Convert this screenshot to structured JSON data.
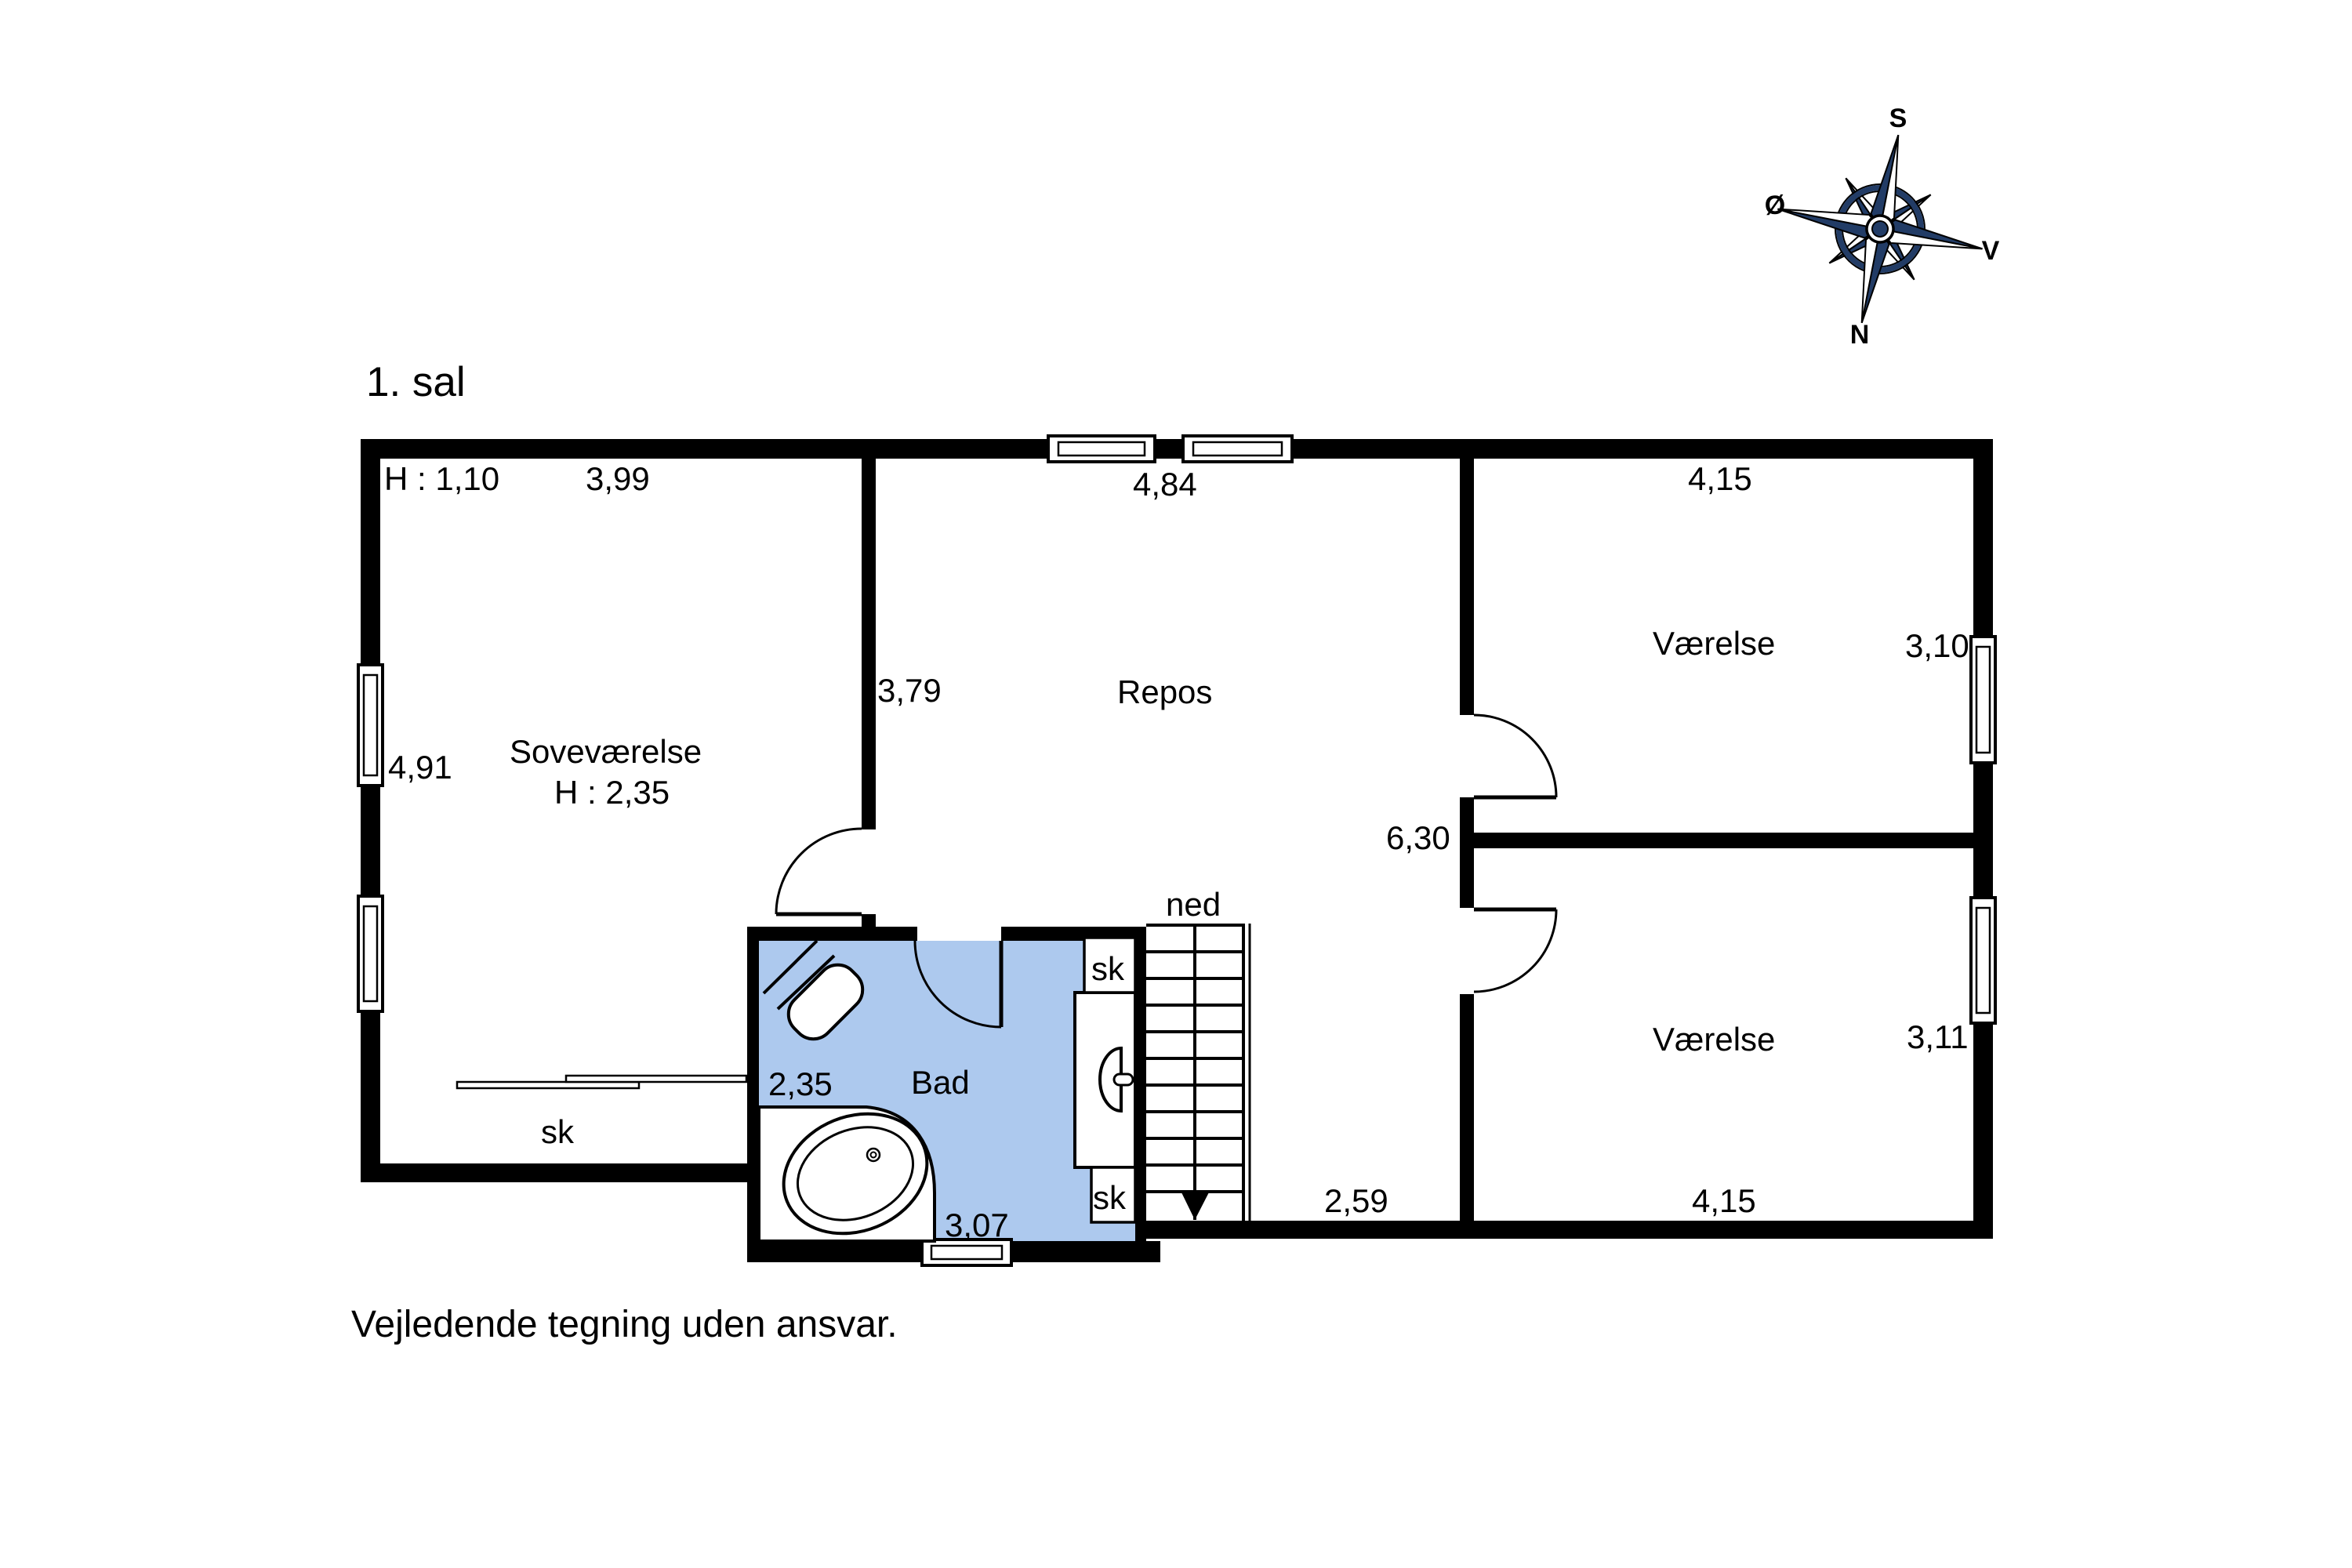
{
  "floor_title": "1. sal",
  "disclaimer": "Vejledende tegning uden ansvar.",
  "compass": {
    "top": "S",
    "left": "Ø",
    "right": "V",
    "bottom": "N"
  },
  "colors": {
    "wall": "#000000",
    "bath_fill": "#adc9ee",
    "compass_navy": "#223c66"
  },
  "rooms": {
    "sovevaerelse": {
      "name": "Soveværelse",
      "ceiling_height": "H : 2,35",
      "low_ceiling_note": "H : 1,10",
      "width": "3,99",
      "depth": "4,91",
      "closet": "sk"
    },
    "repos": {
      "name": "Repos",
      "width": "4,84",
      "depth": "3,79",
      "hall_length": "6,30",
      "hall_bottom_width": "2,59",
      "stairs_label": "ned"
    },
    "bad": {
      "name": "Bad",
      "width_upper": "2,35",
      "width_lower": "3,07",
      "closet_top": "sk",
      "closet_bottom": "sk"
    },
    "vaerelse_upper": {
      "name": "Værelse",
      "width": "4,15",
      "depth": "3,10"
    },
    "vaerelse_lower": {
      "name": "Værelse",
      "width": "4,15",
      "depth": "3,11"
    }
  }
}
